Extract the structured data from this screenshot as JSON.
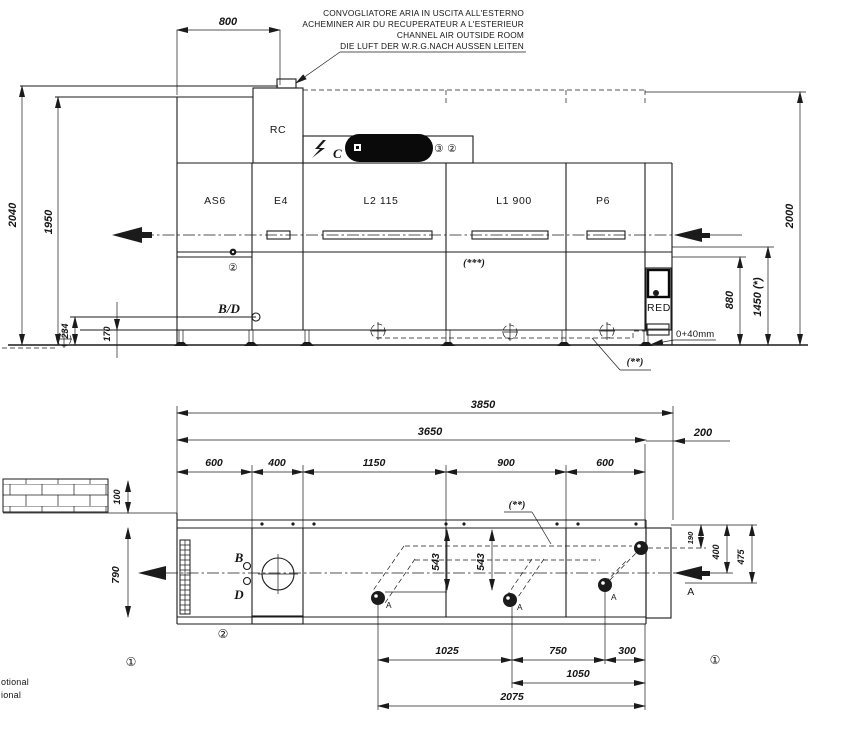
{
  "air_note": {
    "l1": "CONVOGLIATORE ARIA IN USCITA ALL'ESTERNO",
    "l2": "ACHEMINER AIR DU RECUPERATEUR A L'ESTERIEUR",
    "l3": "CHANNEL AIR OUTSIDE ROOM",
    "l4": "DIE LUFT DER W.R.G.NACH AUSSEN LEITEN"
  },
  "glyphs": {
    "c1": "①",
    "c2": "②",
    "c3": "③"
  },
  "elevation": {
    "sections": {
      "rc": "RC",
      "as6": "AS6",
      "e4": "E4",
      "l2": "L2  115",
      "l1": "L1 900",
      "p6": "P6",
      "red": "RED"
    },
    "labels": {
      "bd": "B/D",
      "c": "C",
      "note_2star": "(**)",
      "note_3star": "(***)",
      "zero40": "0+40mm"
    },
    "dims": {
      "w800": "800",
      "h2040": "2040",
      "h1950": "1950",
      "h234": "234",
      "h170": "170",
      "h880": "880",
      "h1450": "1450 (*)",
      "h2000": "2000"
    }
  },
  "plan": {
    "labels": {
      "b": "B",
      "d": "D",
      "a": "A",
      "note_2star": "(**)"
    },
    "dims": {
      "w3850": "3850",
      "w3650": "3650",
      "w200": "200",
      "w600": "600",
      "w400": "400",
      "w1150": "1150",
      "w900": "900",
      "h100": "100",
      "h790": "790",
      "h543": "543",
      "h190": "190",
      "h400": "400",
      "h475": "475",
      "w1025": "1025",
      "w750": "750",
      "w300": "300",
      "w1050": "1050",
      "w2075": "2075"
    }
  },
  "footer": {
    "l1": "otional",
    "l2": "ional"
  }
}
